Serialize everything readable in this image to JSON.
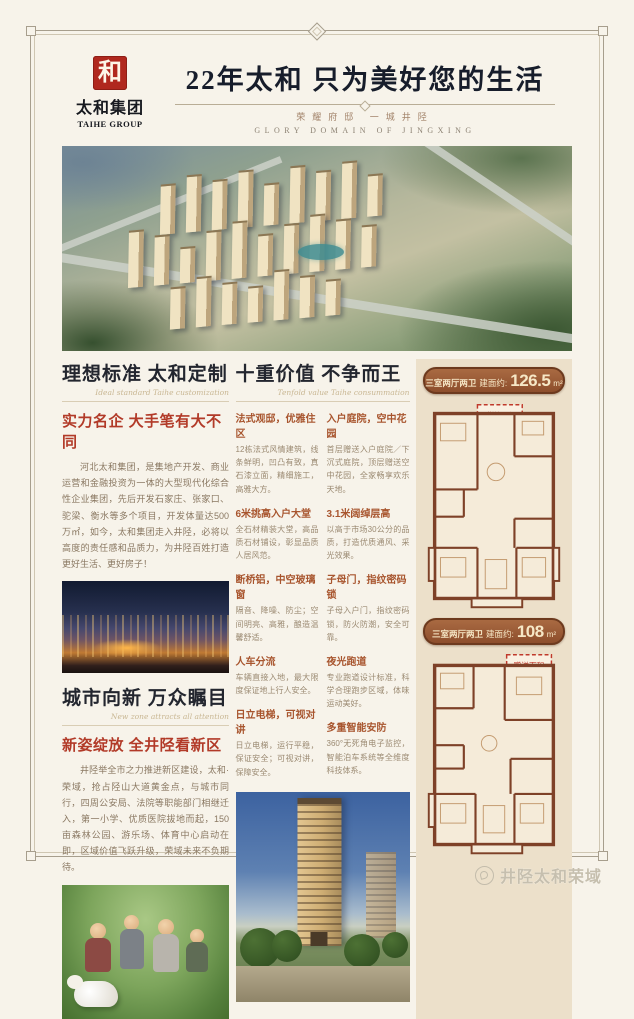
{
  "header": {
    "logo_char": "和",
    "logo_name": "太和集团",
    "logo_en": "TAIHE GROUP",
    "title": "22年太和  只为美好您的生活",
    "subtitle_cn": "荣耀府邸  一城井陉",
    "subtitle_en": "GLORY DOMAIN OF JINGXING"
  },
  "left_top": {
    "heading": "理想标准  太和定制",
    "script": "Ideal standard Taihe customization",
    "subheading": "实力名企  大手笔有大不同",
    "body": "河北太和集团，是集地产开发、商业运营和金融投资为一体的大型现代化综合性企业集团，先后开发石家庄、张家口、驼梁、衡水等多个项目，开发体量达500万㎡，如今，太和集团走入井陉，必将以高度的责任感和品质力，为井陉百姓打造更好生活、更好房子！"
  },
  "left_bottom": {
    "heading": "城市向新  万众瞩目",
    "script": "New zone attracts all attention",
    "subheading": "新姿绽放 全井陉看新区",
    "body": "井陉举全市之力推进新区建设，太和·荣域，抢占陉山大道黄金点，与城市同行，四周公安局、法院等职能部门相继迁入，第一小学、优质医院拔地而起，150亩森林公园、游乐场、体育中心启动在即，区域价值飞跃升级，荣域未来不负期待。"
  },
  "middle": {
    "heading": "十重价值  不争而王",
    "script": "Tenfold value Taihe consummation",
    "items_left": [
      {
        "title": "法式观邸，优雅住区",
        "body": "12栋法式风情建筑，线条鲜明，凹凸有致，真石漆立面，精细施工，高雅大方。"
      },
      {
        "title": "6米挑高入户大堂",
        "body": "全石材精装大堂，高品质石材铺设，彰显品质人居风范。"
      },
      {
        "title": "断桥铝，中空玻璃窗",
        "body": "隔音、降噪、防尘；空间明亮、高雅，酿造温馨舒适。"
      },
      {
        "title": "人车分流",
        "body": "车辆直接入地，最大限度保证地上行人安全。"
      },
      {
        "title": "日立电梯，可视对讲",
        "body": "日立电梯，运行平稳，保证安全；可视对讲，保障安全。"
      }
    ],
    "items_right": [
      {
        "title": "入户庭院，空中花园",
        "body": "首层赠送入户庭院／下沉式庭院，顶层赠送空中花园，全家畅享欢乐天地。"
      },
      {
        "title": "3.1米阔绰层高",
        "body": "以高于市场30公分的品质，打造优质通风、采光效果。"
      },
      {
        "title": "子母门，指纹密码锁",
        "body": "子母入户门，指纹密码锁，防火防潮，安全可靠。"
      },
      {
        "title": "夜光跑道",
        "body": "专业跑道设计标准，科学合理跑步区域，体味运动美好。"
      },
      {
        "title": "多重智能安防",
        "body": "360°无死角电子监控，智能泊车系统等全维度科技体系。"
      }
    ]
  },
  "floorplans": [
    {
      "type": "三室两厅两卫",
      "area_label": "建面约:",
      "area": "126.5",
      "unit": "m²",
      "bonus_tag": "赠送面积"
    },
    {
      "type": "三室两厅两卫",
      "area_label": "建面约:",
      "area": "108",
      "unit": "m²",
      "bonus_tag": "赠送面积"
    }
  ],
  "footer": {
    "account": "井陉太和荣域"
  },
  "colors": {
    "accent_red": "#b23a28",
    "badge_brown": "#8d4e2c",
    "wall_brown": "#7e4128",
    "panel_tan": "#ece0ca"
  }
}
